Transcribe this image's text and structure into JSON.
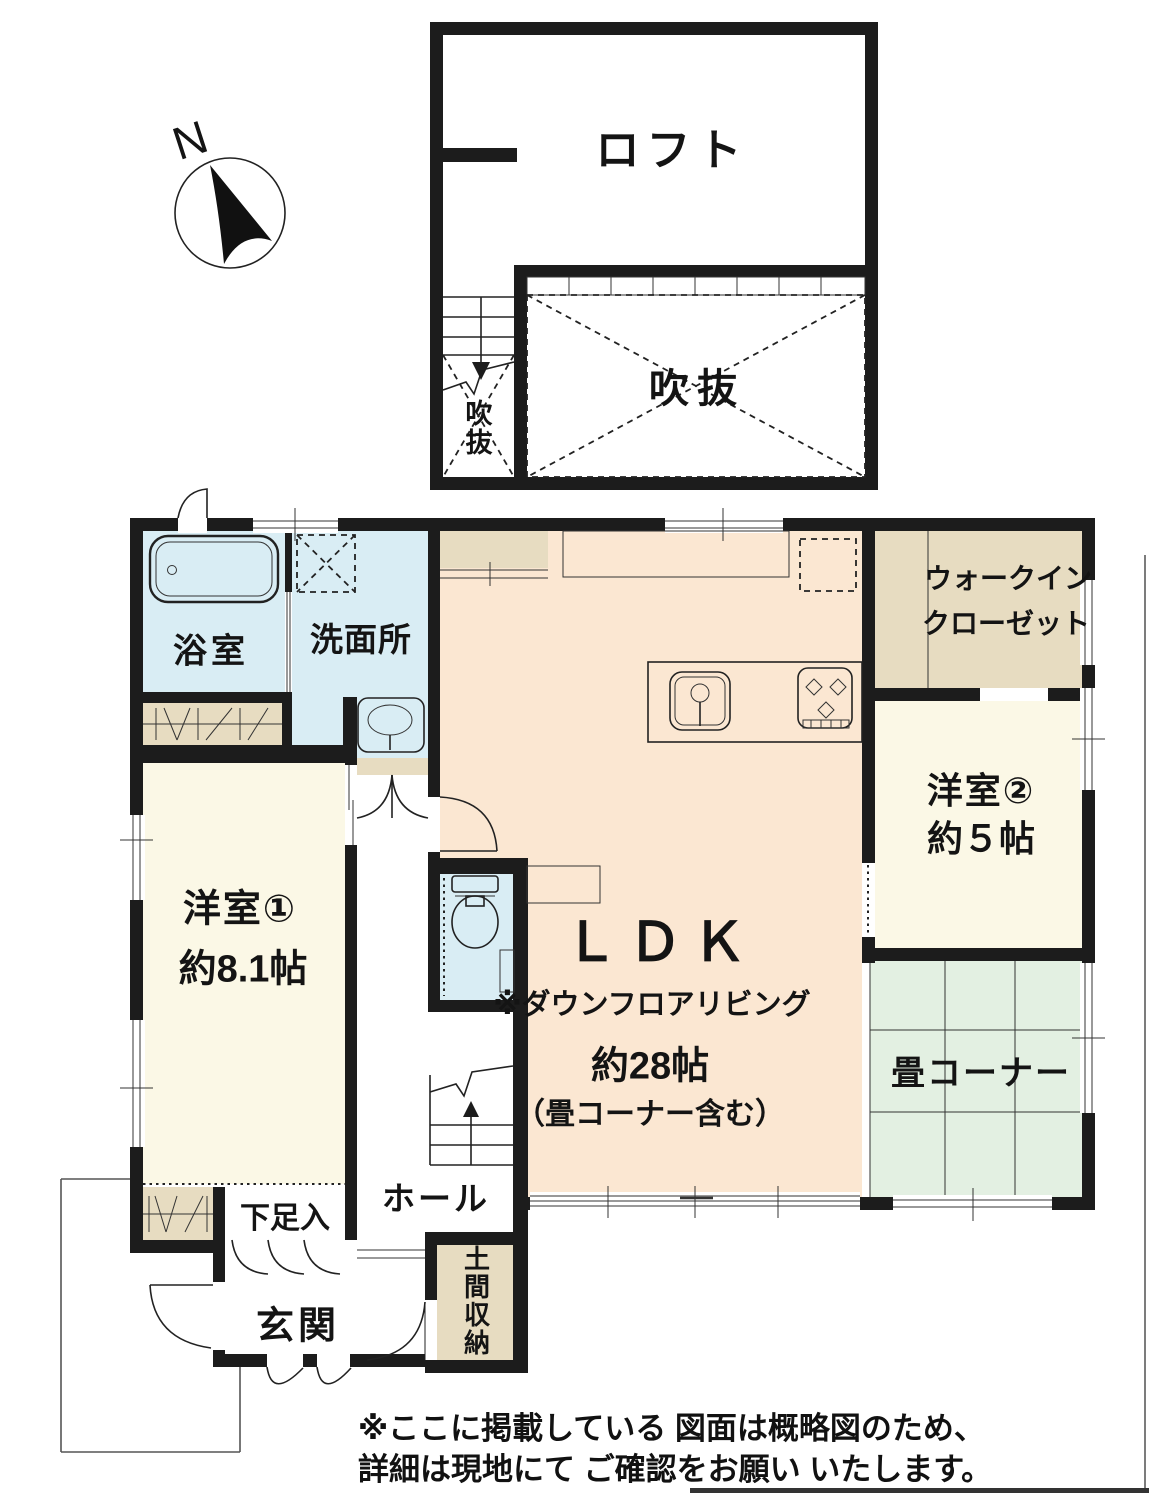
{
  "compass": {
    "north_label": "N"
  },
  "loft": {
    "room_label": "ロフト",
    "void_main_label": "吹抜",
    "void_stair_label": "吹抜"
  },
  "first_floor": {
    "bathroom_label": "浴室",
    "washroom_label": "洗面所",
    "western_room_1_label": "洋室①",
    "western_room_1_size": "約8.1帖",
    "western_room_2_label": "洋室②",
    "western_room_2_size": "約５帖",
    "walk_in_closet_line1": "ウォークイン",
    "walk_in_closet_line2": "クローゼット",
    "ldk_label": "ＬＤＫ",
    "ldk_note": "※ダウンフロアリビング",
    "ldk_size": "約28帖",
    "ldk_size_note": "（畳コーナー含む）",
    "tatami_corner_label": "畳コーナー",
    "hall_label": "ホール",
    "shoe_cabinet_label": "下足入",
    "entrance_label": "玄関",
    "doma_storage_label": "土間収納"
  },
  "disclaimer": {
    "line1": "※ここに掲載している 図面は概略図のため、",
    "line2": "詳細は現地にて ご確認をお願い いたします。"
  },
  "colors": {
    "ldk_peach": "#fbe7d2",
    "wet_area_blue": "#d9edf4",
    "room_cream": "#fbf8e6",
    "closet_beige": "#e7dcc1",
    "tatami_green": "#e3f0e2",
    "wall_black": "#1c1c1c"
  }
}
